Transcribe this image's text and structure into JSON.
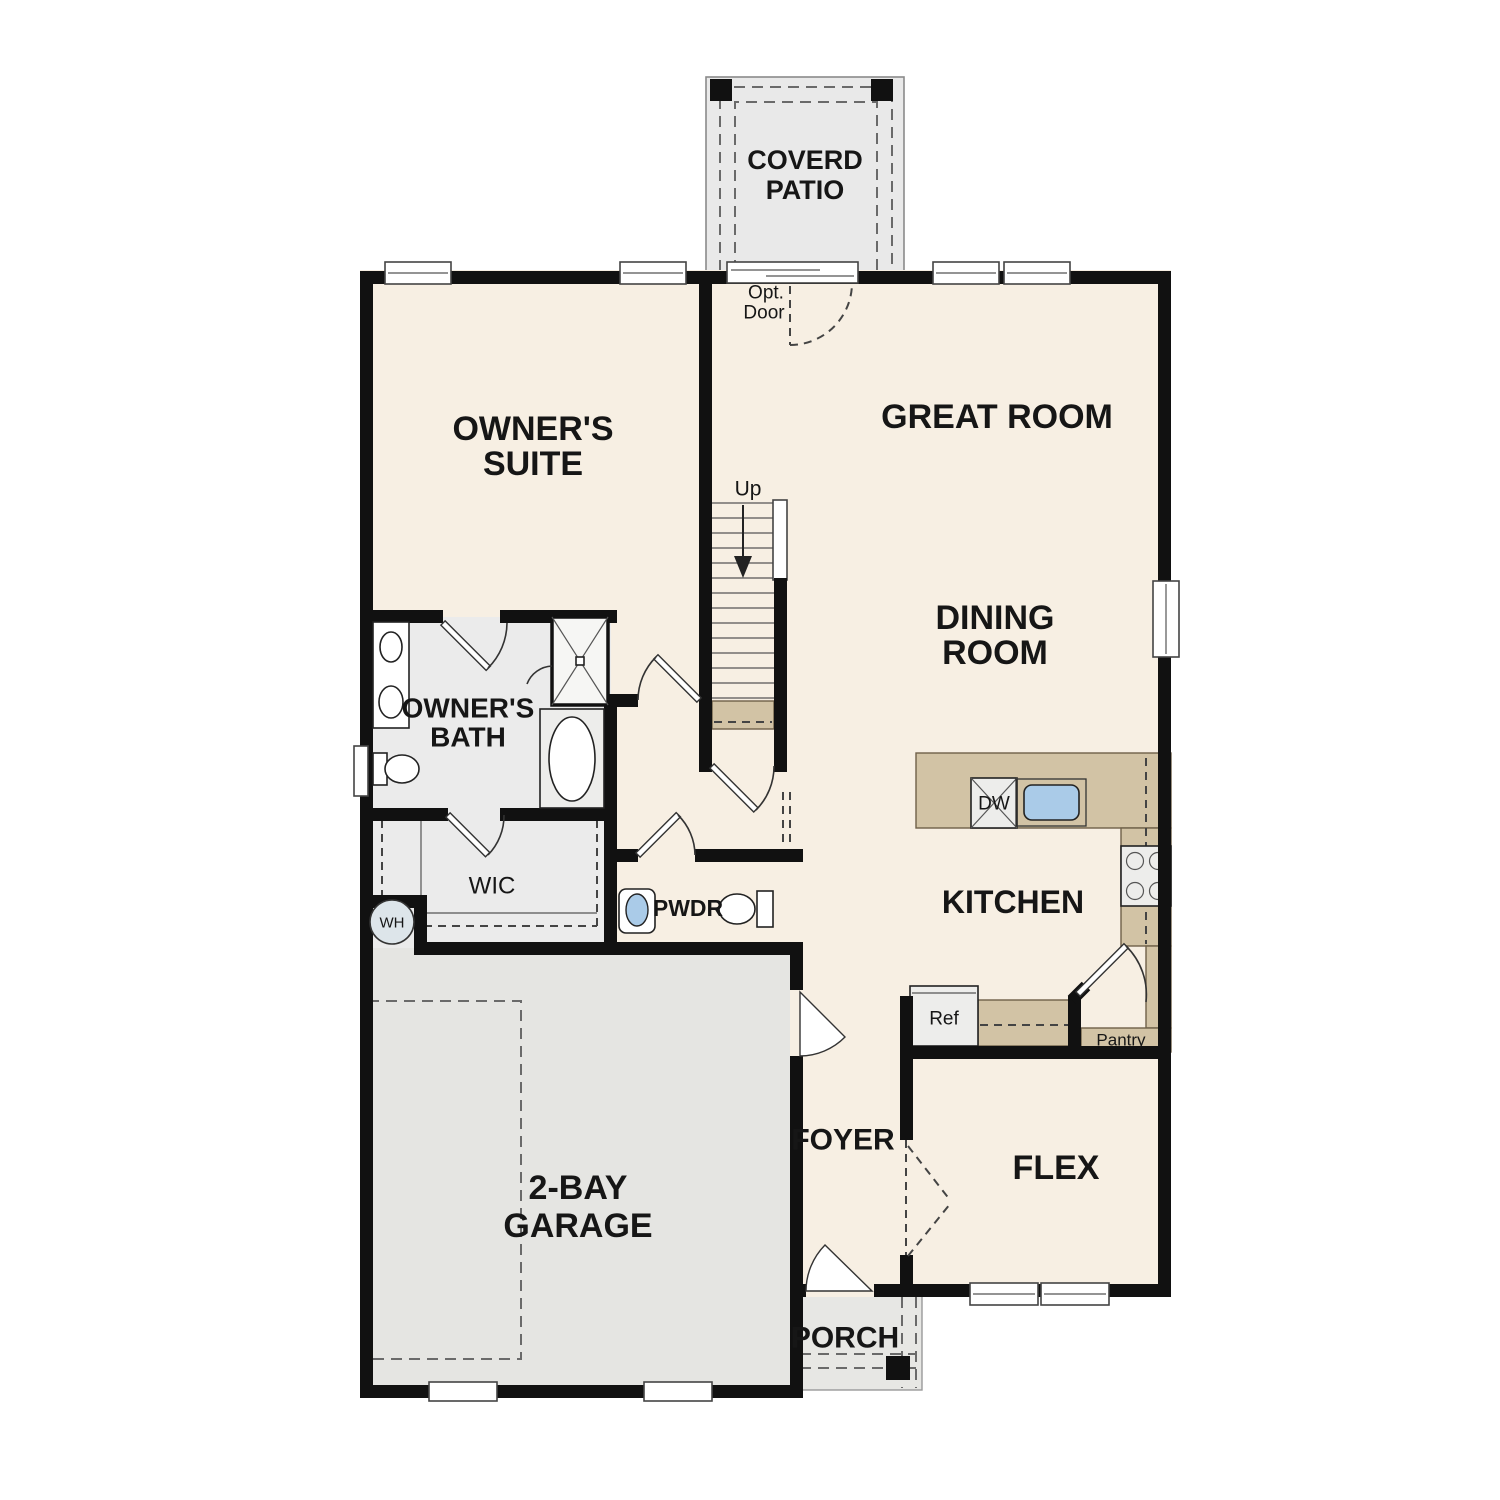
{
  "plan": {
    "title": "First floor plan",
    "colors": {
      "floor_cream": "#f7efe3",
      "room_gray": "#ebebeb",
      "garage_gray": "#e5e5e2",
      "patio_gray": "#e9e9e9",
      "porch_gray": "#e7e7e4",
      "counter_tan": "#d2c3a5",
      "fixture_blue": "#aacbe8",
      "wall_black": "#111111"
    },
    "rooms": {
      "coverd_patio": {
        "line1": "COVERD",
        "line2": "PATIO"
      },
      "owners_suite": {
        "line1": "OWNER'S",
        "line2": "SUITE"
      },
      "great_room": {
        "label": "GREAT ROOM"
      },
      "dining_room": {
        "line1": "DINING",
        "line2": "ROOM"
      },
      "owners_bath": {
        "line1": "OWNER'S",
        "line2": "BATH"
      },
      "wic": {
        "label": "WIC"
      },
      "pwdr": {
        "label": "PWDR"
      },
      "kitchen": {
        "label": "KITCHEN"
      },
      "garage": {
        "line1": "2-BAY",
        "line2": "GARAGE"
      },
      "foyer": {
        "label": "FOYER"
      },
      "flex": {
        "label": "FLEX"
      },
      "porch": {
        "label": "PORCH"
      }
    },
    "annotations": {
      "opt_door_line1": "Opt.",
      "opt_door_line2": "Door",
      "up": "Up",
      "wh": "WH",
      "dw": "DW",
      "ref": "Ref",
      "pantry": "Pantry"
    }
  }
}
